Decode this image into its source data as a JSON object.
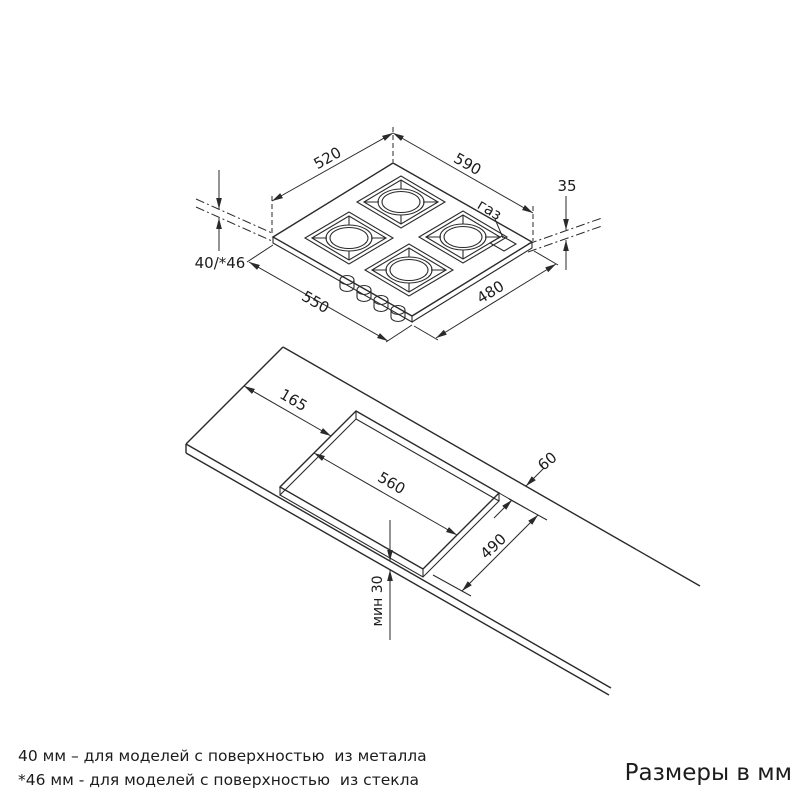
{
  "drawing": {
    "hob": {
      "top_width": "520",
      "top_depth": "590",
      "height_above_counter": "35",
      "gas_label": "газ",
      "install_depth": "40/*46",
      "body_width": "550",
      "body_depth": "480"
    },
    "cutout": {
      "left_offset": "165",
      "length": "560",
      "back_offset": "60",
      "width": "490",
      "front_min": "мин 30"
    }
  },
  "notes": {
    "note_metal": "40 мм – для моделей с поверхностью  из металла",
    "note_glass": "*46 мм - для моделей с поверхностью  из стекла"
  },
  "units_label": "Размеры в мм",
  "colors": {
    "line": "#2a2a2a",
    "background": "#ffffff"
  }
}
